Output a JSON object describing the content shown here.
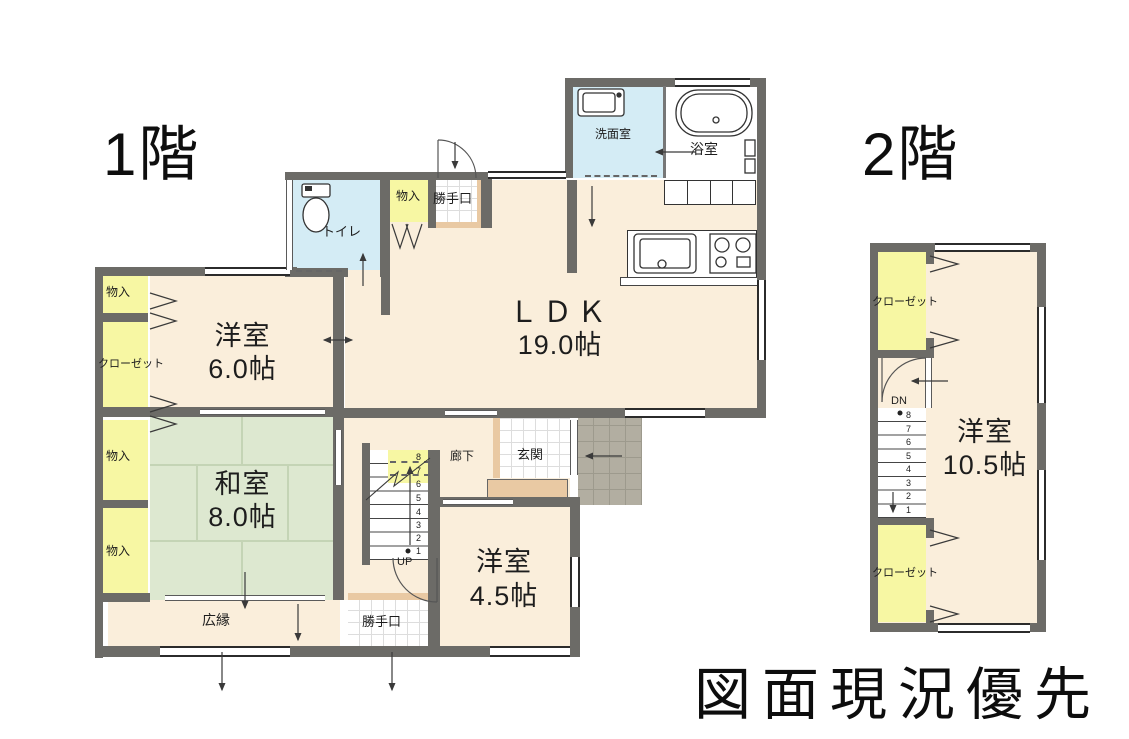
{
  "floor1": {
    "title": "1階",
    "labels": {
      "senmenshitsu": "洗面室",
      "yokushitsu": "浴室",
      "toire": "トイレ",
      "monoiri_top": "物入",
      "katteguchi_top": "勝手口",
      "ldk_name": "ＬＤＫ",
      "ldk_size": "19.0帖",
      "yoshitsu6_name": "洋室",
      "yoshitsu6_size": "6.0帖",
      "monoiri_left1": "物入",
      "closet": "クローゼット",
      "monoiri_left2": "物入",
      "monoiri_left3": "物入",
      "washitsu_name": "和室",
      "washitsu_size": "8.0帖",
      "hiroen": "広縁",
      "katteguchi_bottom": "勝手口",
      "roka": "廊下",
      "genkan": "玄関",
      "yoshitsu45_name": "洋室",
      "yoshitsu45_size": "4.5帖",
      "stairs_up": "UP",
      "stair_steps": [
        "8",
        "7",
        "6",
        "5",
        "4",
        "3",
        "2",
        "1"
      ]
    }
  },
  "floor2": {
    "title": "2階",
    "labels": {
      "closet_top": "クローゼット",
      "yoshitsu_name": "洋室",
      "yoshitsu_size": "10.5帖",
      "closet_bottom": "クローゼット",
      "stairs_down": "DN",
      "stair_steps": [
        "8",
        "7",
        "6",
        "5",
        "4",
        "3",
        "2",
        "1"
      ]
    }
  },
  "footer_note": "図面現況優先",
  "colors": {
    "wall": "#6c6b67",
    "floor_cream": "#faeedb",
    "tatami_green": "#dde8d0",
    "closet_yellow": "#f7f7a3",
    "wet_blue": "#d4ecf5",
    "wood_tan": "#e9c9a3",
    "porch_gray": "#b2aea1"
  }
}
